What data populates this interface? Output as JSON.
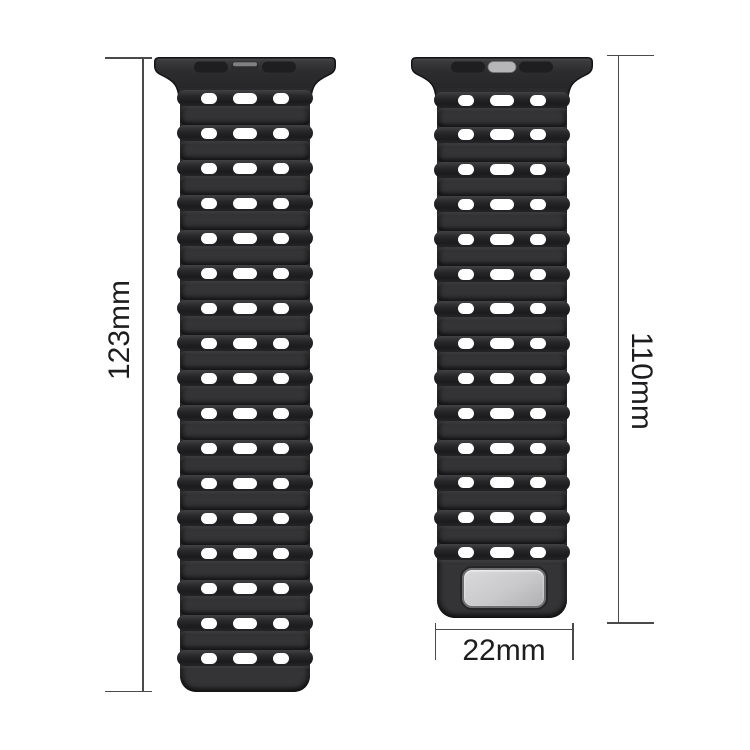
{
  "title": "Watch strap dimension diagram",
  "background_color": "#ffffff",
  "dimensions": {
    "left_strap_length": "123mm",
    "right_strap_length": "110mm",
    "strap_width": "22mm"
  },
  "straps": {
    "left": {
      "name": "long strap piece",
      "hole_rows": 17,
      "holes_per_row": 3,
      "has_buckle_plate": false,
      "connector_center_slot": "dark"
    },
    "right": {
      "name": "short strap piece",
      "hole_rows": 14,
      "holes_per_row": 3,
      "has_buckle_plate": true,
      "connector_center_slot": "light"
    }
  },
  "colors": {
    "background": "#ffffff",
    "strap_base": "#2a2a2c",
    "strap_ridge": "#343436",
    "strap_valley_dark": "#1b1b1d",
    "hole": "#ffffff",
    "connector_slot_dark": "#1e1e20",
    "connector_slot_light": "#b6b6b8",
    "buckle_plate": "#c9c9cb",
    "dimension_line": "#4a4a4a",
    "label_text": "#1d1d1f"
  }
}
